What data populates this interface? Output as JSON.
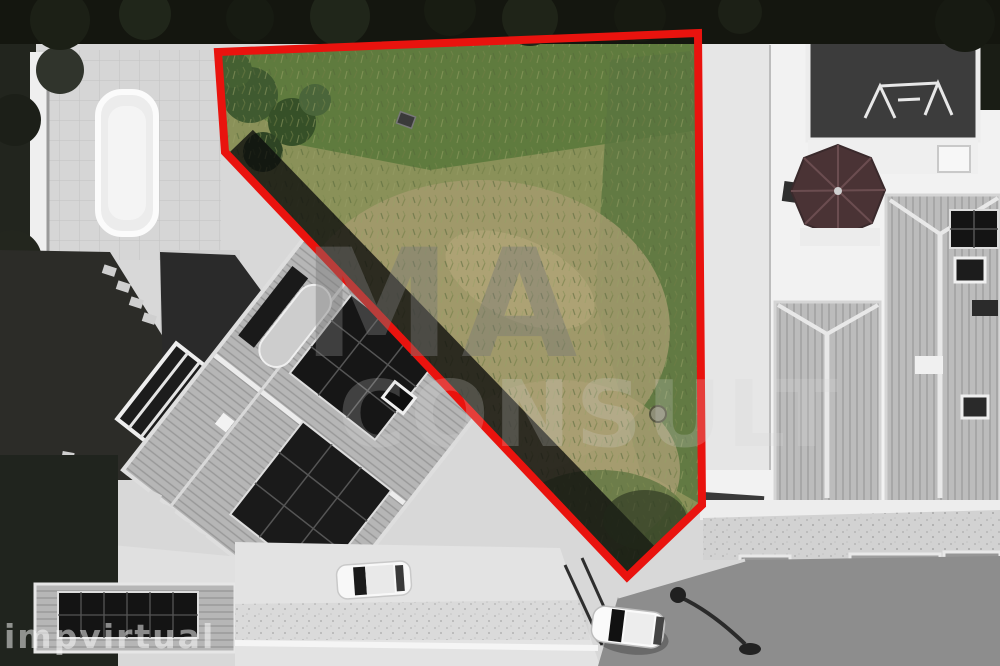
{
  "annotation": {
    "plot_outline": {
      "points": "218,52 698,33 702,505 627,577 225,152",
      "stroke_color": "#e9130e",
      "stroke_width": "8"
    }
  },
  "watermarks": {
    "center_line1": "MA",
    "center_line2": "CONSULT",
    "corner": "impvirtual"
  },
  "palette": {
    "outline_red": "#e9130e",
    "grass_base": "#8a9159",
    "grass_green_top": "#5d7a3d",
    "grass_green_right": "#5a7540",
    "dry_grass": "#a39a6d",
    "dry_grass_light": "#b5a87c",
    "bush_green": "#3f5a30",
    "shadow_dark": "#0b0b0b",
    "roof_gray": "#b9b9b9",
    "solar_panel": "#161616",
    "pool_white": "#ececec",
    "paving_light": "#d6d6d6",
    "asphalt": "#8d8d8d",
    "tree_dark": "#1d201a",
    "umbrella_dark": "#4a3335",
    "car_white": "#fafafa"
  }
}
